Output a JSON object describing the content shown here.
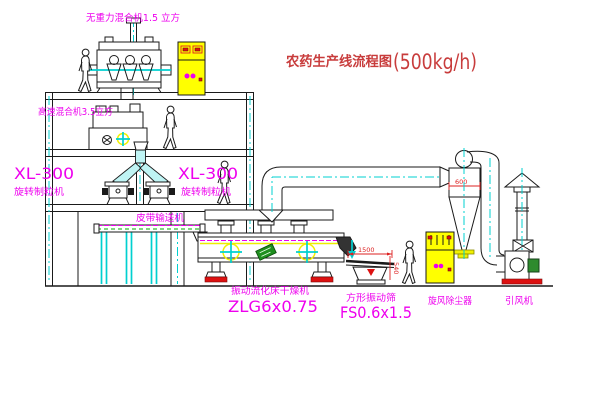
{
  "title": {
    "name": "农药生产线流程图",
    "capacity": "(500kg/h)"
  },
  "equipment_labels": {
    "gravity_free_mixer": "无重力混合机1.5 立方",
    "high_speed_mixer": "高速混合机3.5立方",
    "granulator_left_model": "XL-300",
    "granulator_left_name": "旋转制粒机",
    "granulator_right_model": "XL-300",
    "granulator_right_name": "旋转制粒机",
    "belt_conveyor": "皮带输送机",
    "fluid_bed_dryer": "振动流化床干燥机",
    "fluid_bed_dryer_model": "ZLG6x0.75",
    "square_sieve": "方形振动筛",
    "square_sieve_model": "FS0.6x1.5",
    "cyclone": "旋风除尘器",
    "induced_draft_fan": "引风机"
  },
  "dimensions": {
    "sieve_length": "1500",
    "sieve_height": "540",
    "cyclone_diameter": "600"
  },
  "colors": {
    "line": "#1a1a1a",
    "label_magenta": "#ee00ee",
    "title_red": "#c83c3c",
    "dimension_red": "#dd2222",
    "centerline_cyan": "#00d0d0",
    "highlight_yellow": "#ffff00",
    "motor_green": "#2e8b2e",
    "foot_red": "#dd1111"
  }
}
